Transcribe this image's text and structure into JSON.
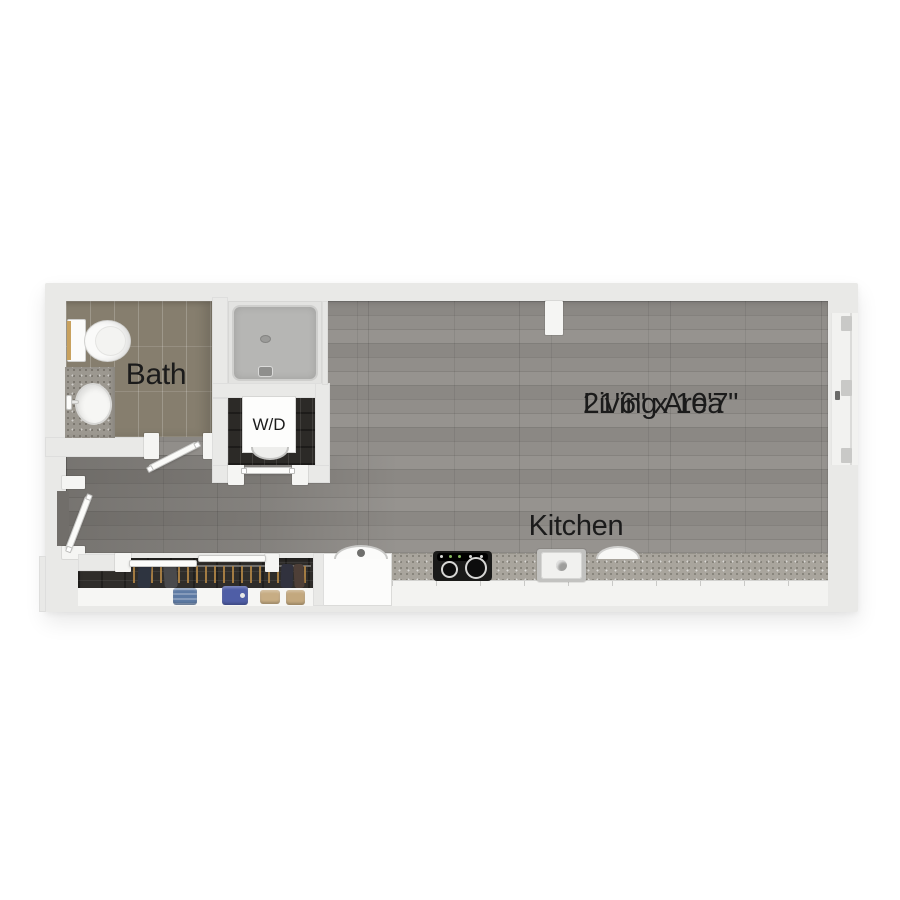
{
  "plan": {
    "rooms": {
      "bath": {
        "label": "Bath"
      },
      "laundry": {
        "label": "W/D"
      },
      "living": {
        "label": "Living Area",
        "dimensions": "21'6\" x 10'7\""
      },
      "kitchen": {
        "label": "Kitchen"
      }
    },
    "fixtures": [
      "toilet",
      "bathroom-vanity-sink",
      "shower",
      "washer-dryer",
      "stove-cooktop",
      "kitchen-sink",
      "island-sink",
      "kitchen-counter",
      "closet-rod-with-hangers",
      "folded-clothes-shelf",
      "entry-swing-door",
      "bath-swing-door",
      "laundry-door",
      "closet-sliding-doors",
      "window-wall"
    ],
    "colors": {
      "background": "#ffffff",
      "wall": "#e9e9e7",
      "wood_floor": "#8f8c88",
      "hall_floor": "#6f6c68",
      "bath_tile": "#867e6e",
      "dark_wood": "#2f2d2a",
      "countertop_speckle": "#a9a59d",
      "shower_pan": "#b6b6b4",
      "label_text": "#1b1b1b",
      "hanger": "#b08445",
      "denim_blue": "#5d7aa3",
      "folded_blue": "#4f5ea6",
      "folded_tan": "#c7ad84",
      "tank_accent": "#c8a15e"
    }
  }
}
